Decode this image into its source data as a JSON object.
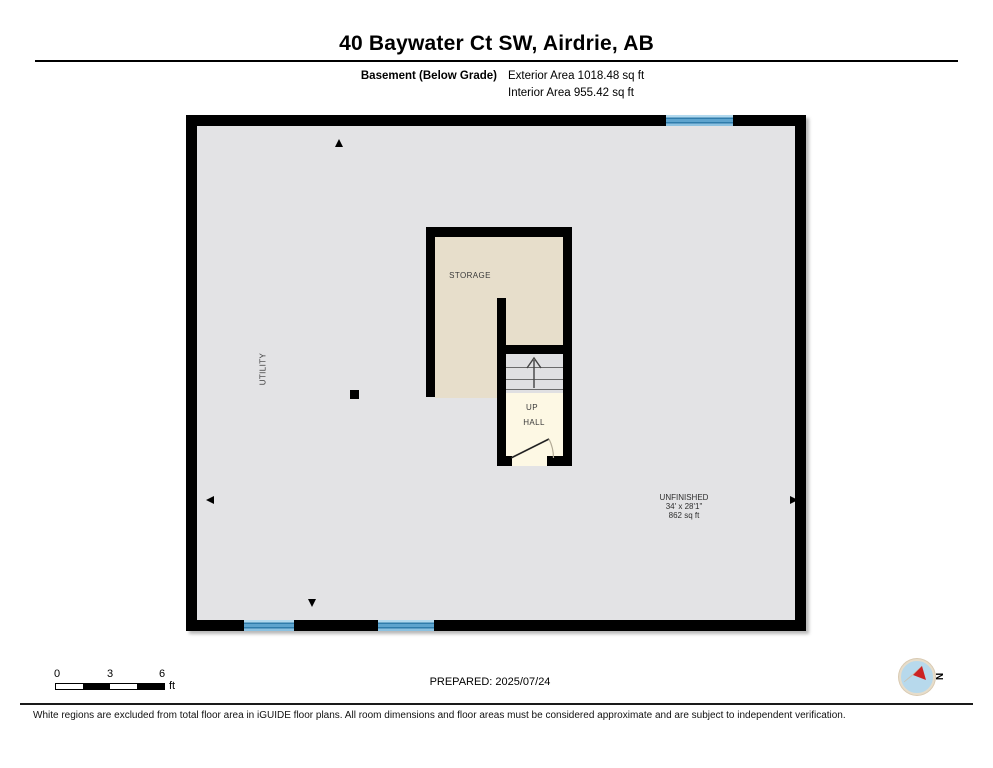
{
  "header": {
    "title": "40 Baywater Ct SW, Airdrie, AB",
    "floor_label": "Basement (Below Grade)",
    "exterior_area": "Exterior Area 1018.48 sq ft",
    "interior_area": "Interior Area 955.42 sq ft"
  },
  "plan": {
    "rooms": {
      "storage": "STORAGE",
      "utility": "UTILITY",
      "up": "UP",
      "hall": "HALL",
      "unfinished": {
        "name": "UNFINISHED",
        "dimensions": "34' x 28'1\"",
        "area": "862 sq ft"
      }
    }
  },
  "footer": {
    "scale": {
      "ticks": [
        "0",
        "3",
        "6"
      ],
      "unit": "ft"
    },
    "prepared": "PREPARED: 2025/07/24",
    "compass_n": "N",
    "disclaimer": "White regions are excluded from total floor area in iGUIDE floor plans. All room dimensions and floor areas must be considered approximate and are subject to independent verification."
  },
  "colors": {
    "wall": "#000000",
    "floor_gray": "#e3e3e5",
    "storage_beige": "#e7decb",
    "hall_cream": "#fdf8e4",
    "stairs_gray": "#e0e0e2",
    "window_blue": "#5ea4ce",
    "window_blue_dark": "#2f7cab",
    "window_blue_light": "#b2d9ee",
    "compass_red": "#cc2222",
    "compass_blue": "#b7d9ec"
  }
}
